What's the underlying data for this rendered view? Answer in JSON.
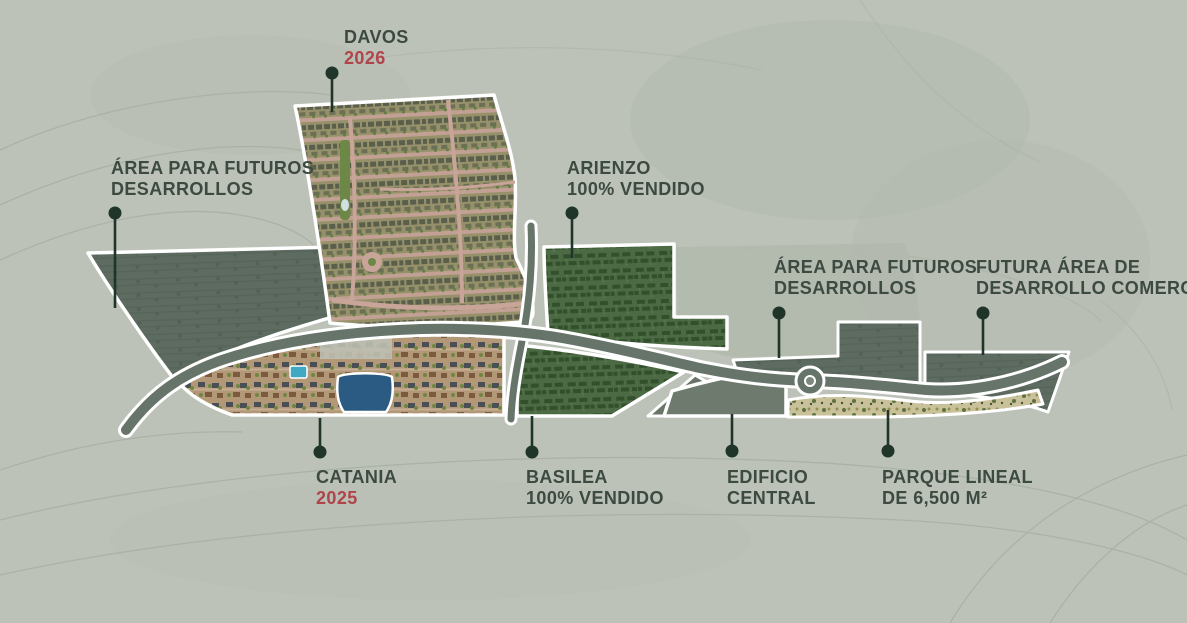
{
  "meta": {
    "canvas_width": 1187,
    "canvas_height": 623
  },
  "colors": {
    "background": "#bcc2b7",
    "label_text": "#3d4a41",
    "accent_red": "#b0444b",
    "marker": "#20352a",
    "parcel_outline": "#ffffff",
    "road": "#66746a",
    "dark_parcel": "#5d6b60",
    "green_parcel": "#4c6a43",
    "park_tan": "#c9c199",
    "lagoon_blue": "#2b5a82"
  },
  "labels": {
    "davos": {
      "line1": "DAVOS",
      "line2": "2026"
    },
    "area_left": {
      "line1": "ÁREA PARA FUTUROS",
      "line2": "DESARROLLOS"
    },
    "arienzo": {
      "line1": "ARIENZO",
      "line2": "100% VENDIDO"
    },
    "area_right": {
      "line1": "ÁREA PARA FUTUROS",
      "line2": "DESARROLLOS"
    },
    "comercial": {
      "line1": "FUTURA ÁREA DE",
      "line2": "DESARROLLO COMERCIAL"
    },
    "catania": {
      "line1": "CATANIA",
      "line2": "2025"
    },
    "basilea": {
      "line1": "BASILEA",
      "line2": "100% VENDIDO"
    },
    "edificio": {
      "line1": "EDIFICIO",
      "line2": "CENTRAL"
    },
    "parque": {
      "line1": "PARQUE LINEAL",
      "line2": "DE 6,500 M²"
    }
  }
}
